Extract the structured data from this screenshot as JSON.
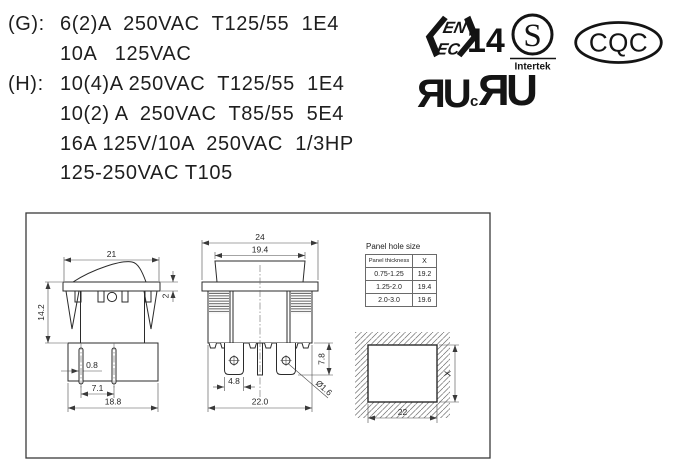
{
  "colors": {
    "ink": "#1d1d1d",
    "background": "#ffffff"
  },
  "ratings": {
    "g_label": "(G):",
    "g_line1": "6(2)A  250VAC  T125/55  1E4",
    "g_line2": "10A   125VAC",
    "h_label": "(H):",
    "h_line1": "10(4)A 250VAC  T125/55  1E4",
    "h_line2": "10(2) A  250VAC  T85/55  5E4",
    "h_line3": "16A 125V/10A  250VAC  1/3HP",
    "h_line4": "125-250VAC T105"
  },
  "certifications": {
    "enec": {
      "row1": "EN",
      "row2": "EC",
      "number": "14"
    },
    "intertek": {
      "letter": "S",
      "name": "Intertek"
    },
    "cqc": {
      "name": "CQC"
    },
    "ul": {
      "mark1": "ЯU",
      "c": "c",
      "mark2": "ЯU"
    }
  },
  "drawing": {
    "panel_table": {
      "title": "Panel hole size",
      "col_thickness": "Panel thickness",
      "col_x": "X",
      "rows": [
        [
          "0.75-1.25",
          "19.2"
        ],
        [
          "1.25-2.0",
          "19.4"
        ],
        [
          "2.0-3.0",
          "19.6"
        ]
      ]
    },
    "side_view": {
      "width_top": "21",
      "height": "14.2",
      "rocker_h": "2",
      "pin_t": "0.8",
      "pin_pitch": "7.1",
      "base_w": "18.8"
    },
    "front_view": {
      "frame_w": "24",
      "rocker_w": "19.4",
      "term_w": "4.8",
      "term_h": "7.8",
      "hole": "Ø1.6",
      "base_w": "22.0"
    },
    "cutout": {
      "width": "22",
      "height": "X"
    }
  }
}
